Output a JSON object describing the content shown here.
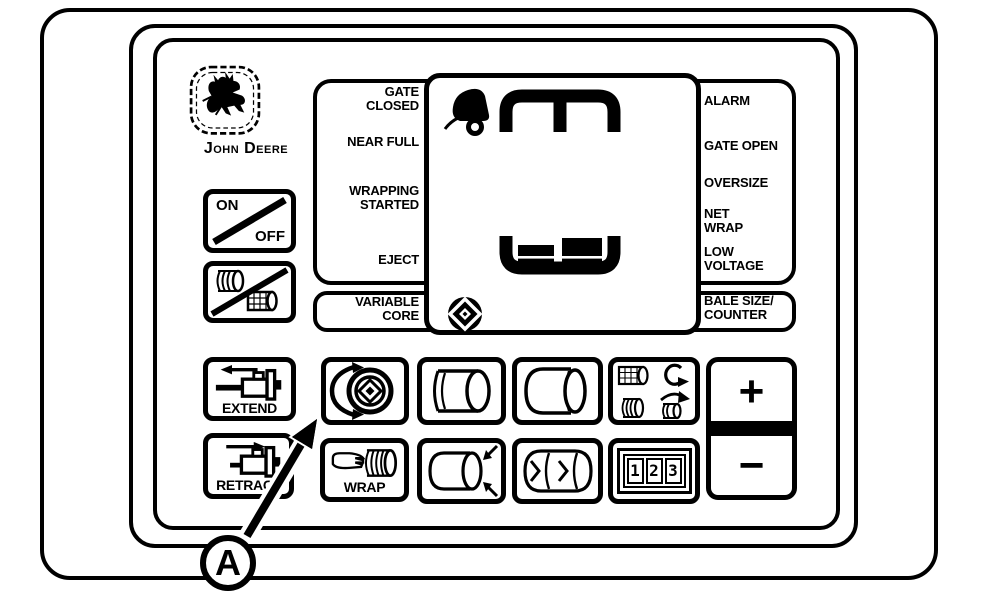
{
  "colors": {
    "ink": "#000000",
    "paper": "#ffffff"
  },
  "brand": {
    "name": "John Deere",
    "logo_icon": "john-deere-deer-icon"
  },
  "power": {
    "on": "ON",
    "off": "OFF"
  },
  "left_controls": {
    "extend": "EXTEND",
    "retract": "RETRACT"
  },
  "status_left": {
    "gate_closed": "GATE\nCLOSED",
    "near_full": "NEAR FULL",
    "wrapping_started": "WRAPPING\nSTARTED",
    "eject": "EJECT",
    "variable_core": "VARIABLE\nCORE"
  },
  "status_right": {
    "alarm": "ALARM",
    "gate_open": "GATE OPEN",
    "oversize": "OVERSIZE",
    "net_wrap": "NET\nWRAP",
    "low_voltage": "LOW\nVOLTAGE",
    "bale_size_counter": "BALE SIZE/\nCOUNTER"
  },
  "keys": {
    "wrap": "WRAP",
    "increase": "+",
    "decrease": "−"
  },
  "counter": {
    "digits": [
      "1",
      "2",
      "3"
    ]
  },
  "callout": {
    "label": "A"
  },
  "icons": {
    "logo": "john-deere-deer-icon",
    "power_slash": "diagonal-slash-icon",
    "twine_net_off": "twine-and-net-roll-slash-icon",
    "extend": "cylinder-extend-icon",
    "retract": "cylinder-retract-icon",
    "variable_core_key": "variable-core-spiral-arrows-icon",
    "bale_face_right": "round-bale-icon",
    "bale_face_left": "round-bale-mirrored-icon",
    "wrap_select": "net-twine-wrap-select-icon",
    "wrap_hand": "hand-pointing-at-roll-icon",
    "bale_diameter": "bale-diameter-arrows-icon",
    "bale_end_wraps": "bale-end-arrows-icon",
    "counter_display": "digital-counter-123-icon",
    "screen_alarm": "alarm-bell-icon",
    "screen_chamber_top": "bale-chamber-top-icon",
    "screen_fill": "bale-fill-bars-icon",
    "screen_core": "variable-core-target-icon"
  }
}
